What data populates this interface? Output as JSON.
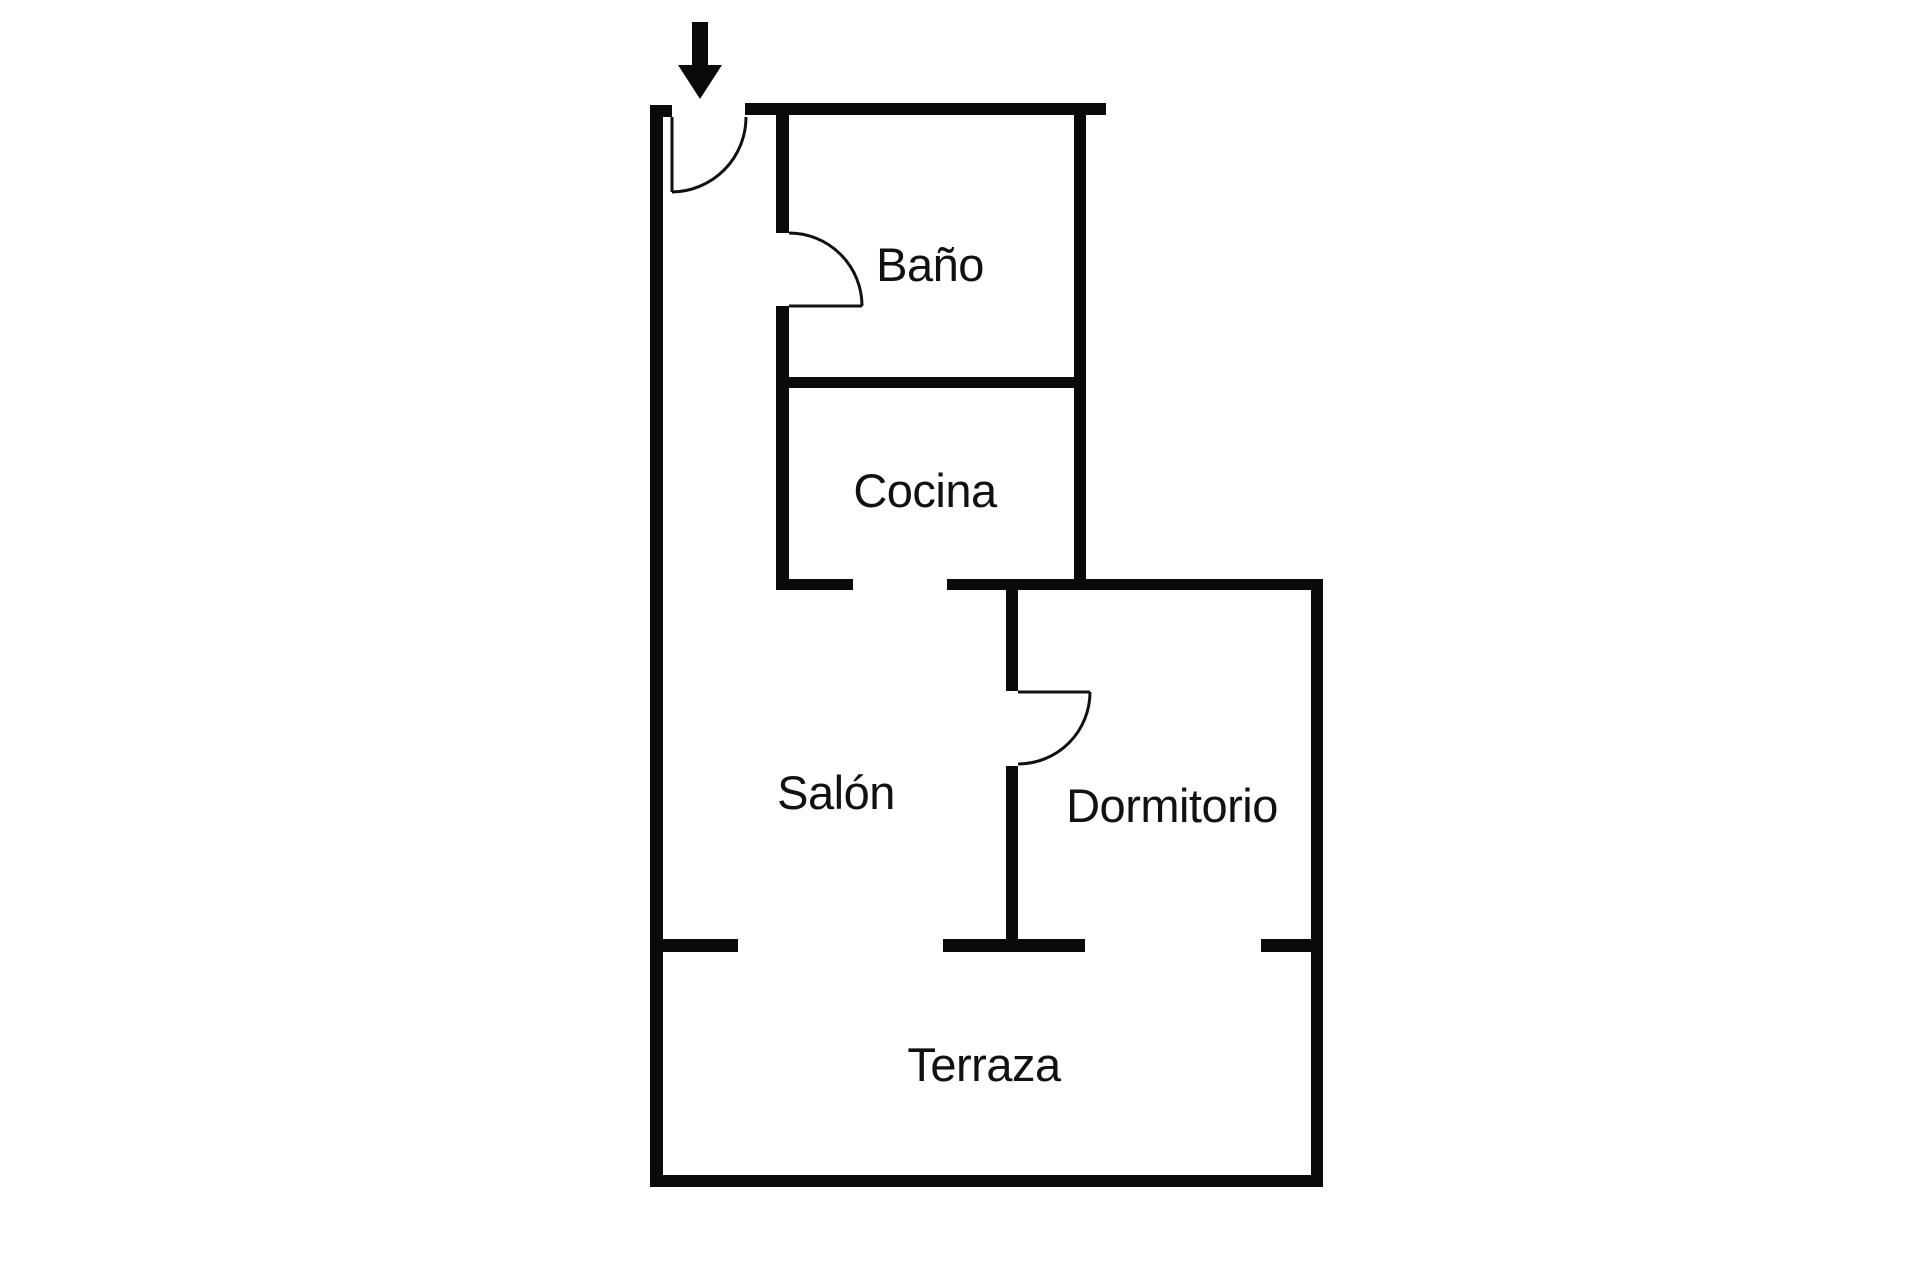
{
  "diagram": {
    "type": "floor-plan",
    "colors": {
      "background": "#ffffff",
      "wall": "#0a0a0a",
      "text": "#111111"
    },
    "rooms": [
      {
        "id": "bano",
        "label": "Baño"
      },
      {
        "id": "cocina",
        "label": "Cocina"
      },
      {
        "id": "salon",
        "label": "Salón"
      },
      {
        "id": "dormitorio",
        "label": "Dormitorio"
      },
      {
        "id": "terraza",
        "label": "Terraza"
      }
    ],
    "entrance": {
      "icon": "entrance-arrow-icon"
    },
    "doors": [
      {
        "id": "entrance-door"
      },
      {
        "id": "bano-door"
      },
      {
        "id": "dormitorio-door"
      }
    ]
  }
}
